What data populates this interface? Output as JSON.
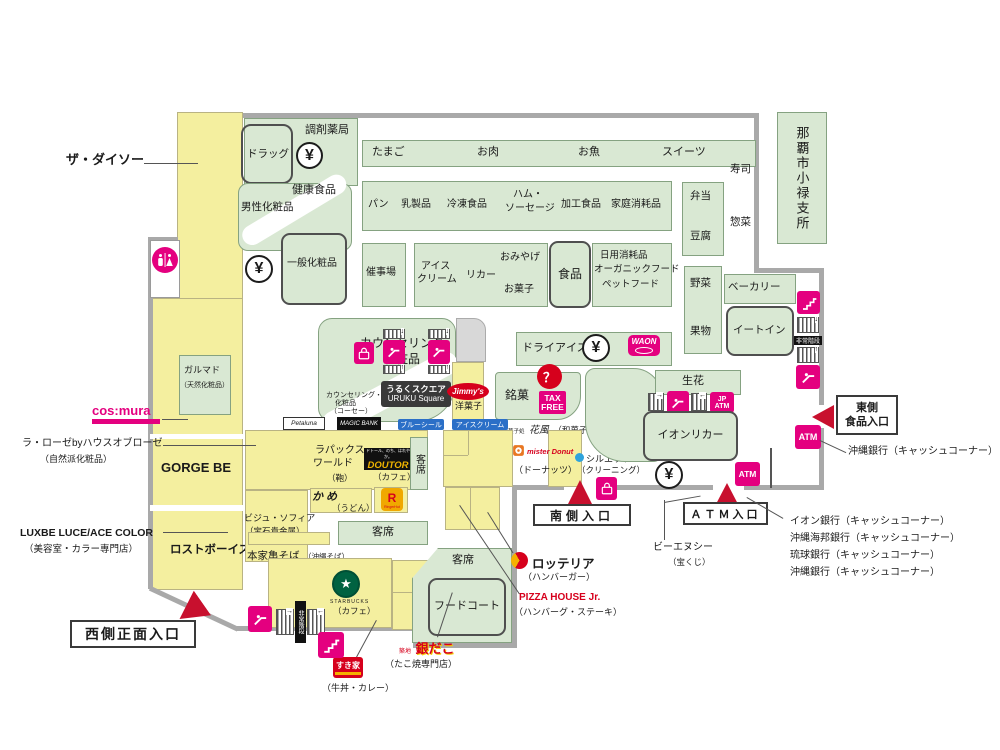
{
  "palette": {
    "green": "#d9e8d3",
    "yellow": "#f4ef9f",
    "pink": "#e4007f",
    "red": "#c8102e",
    "wall": "#a9a9a9"
  },
  "outside": {
    "daiso": "ザ・ダイソー",
    "office": "那覇市小禄支所",
    "larose": "ラ・ローゼbyハウスオブローゼ",
    "larose_sub": "（自然派化粧品）",
    "luxbe": "LUXBE LUCE/ACE COLOR",
    "luxbe_sub": "（美容室・カラー専門店）",
    "west_entrance": "西側正面入口",
    "south_entrance": "南側入口",
    "atm_entrance": "ＡＴＭ入口",
    "east_entrance_1": "東側",
    "east_entrance_2": "食品入口",
    "okinawa_bank_note": "沖縄銀行（キャッシュコーナー）",
    "bnc": "ビーエヌシー",
    "bnc_sub": "（宝くじ）",
    "bank_list": [
      "イオン銀行（キャッシュコーナー）",
      "沖縄海邦銀行（キャッシュコーナー）",
      "琉球銀行（キャッシュコーナー）",
      "沖縄銀行（キャッシュコーナー）"
    ]
  },
  "depts": {
    "pharmacy": "調剤薬局",
    "drug": "ドラッグ",
    "egg": "たまご",
    "meat": "お肉",
    "fish": "お魚",
    "sweets": "スイーツ",
    "health": "健康食品",
    "mens": "男性化粧品",
    "general_cosme": "一般化粧品",
    "bread": "パン",
    "dairy": "乳製品",
    "frozen": "冷凍食品",
    "ham_1": "ハム・",
    "ham_2": "ソーセージ",
    "processed": "加工食品",
    "household": "家庭消耗品",
    "event": "催事場",
    "ice_1": "アイス",
    "ice_2": "クリーム",
    "liquor": "リカー",
    "souvenir": "おみやげ",
    "confectionery": "お菓子",
    "food": "食品",
    "daily": "日用消耗品",
    "organic": "オーガニックフード",
    "pet": "ペットフード",
    "bento": "弁当",
    "tofu": "豆腐",
    "sushi": "寿司",
    "deli": "惣菜",
    "vegetable": "野菜",
    "fruit": "果物",
    "bakery": "ベーカリー",
    "eat_in": "イートイン",
    "counseling_1": "カウンセリング",
    "counseling_2": "化粧品",
    "kose_1": "カウンセリング・",
    "kose_2": "化粧品",
    "kose_3": "（コーセー）",
    "dry_ice": "ドライアイス・氷",
    "meika": "銘菓",
    "flower": "生花",
    "aeon_liquor": "イオンリカー",
    "seats": "客席",
    "food_court": "フードコート"
  },
  "tenants": {
    "garumado": "ガルマド",
    "garumado_sub": "（天然化粧品）",
    "gorge_be": "GORGE BE",
    "lost_boys": "ロストボーイズ",
    "lapax_1": "ラパックス",
    "lapax_2": "ワールド",
    "lapax_3": "（鞄）",
    "doutor_sub": "（カフェ）",
    "udon_sub": "（うどん）",
    "bijou": "ビジュ・ソフィア",
    "bijou_sub": "（宝石貴金属）",
    "honke": "本家亀そば",
    "honke_sub": "（沖縄そば）",
    "starbucks_sub": "（カフェ）",
    "sukiya_sub": "（牛丼・カレー）",
    "gindaco_sub": "（たこ焼専門店）",
    "lotteria": "ロッテリア",
    "lotteria_sub": "（ハンバーガー）",
    "pizza": "PIZZA HOUSE Jr.",
    "pizza_sub": "（ハンバーグ・ステーキ）",
    "misdo_sub": "（ドーナッツ）",
    "silhouette": "シルエット",
    "silhouette_sub": "（クリーニング）",
    "jimmys_sub": "洋菓子",
    "hanafu_prefix": "琉球菓子処",
    "hanafu": "花風",
    "hanafu_sub": "（和菓子）"
  },
  "logos": {
    "cosmura": "cos:mura",
    "petaluna": "Petaluna",
    "magic_bank": "MAGIC BANK",
    "doutor_slogan": "ドトール、のち、はれやか。",
    "doutor": "DOUTOR",
    "ringer_r": "R",
    "ringer": "RingerHut",
    "udon": "かめ",
    "starbucks": "STARBUCKS",
    "sukiya": "すき家",
    "gindaco_prefix": "築地",
    "gindaco": "銀だこ",
    "misdo": "mister Donut",
    "jimmys": "Jimmy's",
    "blueseal_1": "ブルーシール",
    "blueseal_2": "アイスクリーム",
    "waon": "WAON",
    "uruku_1": "うるくスクエア",
    "uruku_2": "URUKU Square"
  },
  "icons": {
    "yen": "¥",
    "atm": "ATM",
    "jp": "JP",
    "tax_1": "TAX",
    "tax_2": "FREE",
    "question": "？",
    "emergency": "非常階段"
  }
}
